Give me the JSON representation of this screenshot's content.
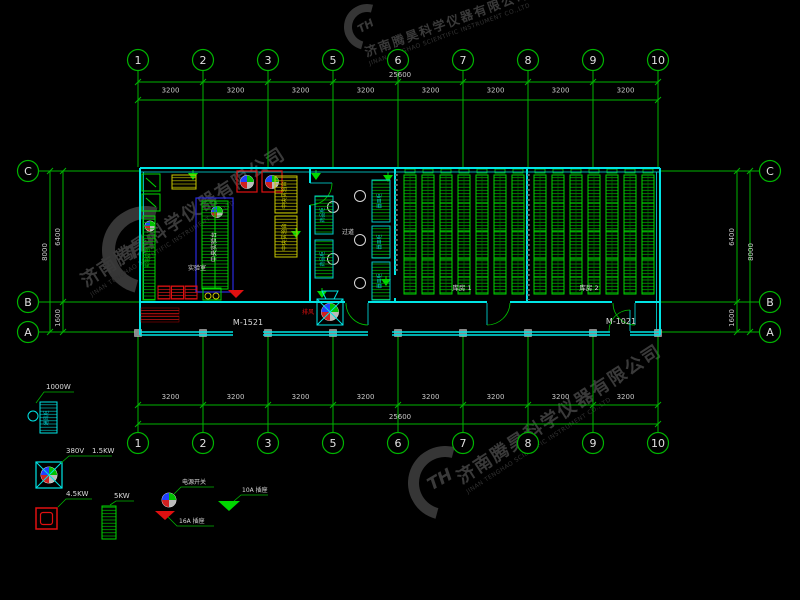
{
  "drawing": {
    "grid": {
      "top_labels": [
        "1",
        "2",
        "3",
        "5",
        "6",
        "7",
        "8",
        "9",
        "10"
      ],
      "bottom_labels": [
        "1",
        "2",
        "3",
        "5",
        "6",
        "7",
        "8",
        "9",
        "10"
      ],
      "left_labels": [
        "C",
        "B",
        "A"
      ],
      "right_labels": [
        "C",
        "B",
        "A"
      ]
    },
    "dims": {
      "segment": "3200",
      "total": "25600",
      "left_inner_top": "6400",
      "left_total": "8000",
      "left_inner_bottom": "1600",
      "right_inner_top": "6400",
      "right_total": "8000",
      "right_inner_bottom": "1600"
    },
    "labels": {
      "door_left": "M-1521",
      "door_right": "M-1021",
      "room_left": "实验室",
      "corridor": "过道",
      "storage1": "库房 1",
      "storage2": "库房 2",
      "central_bench": "中央实验台",
      "yellow_bench": "中央实验台",
      "side_bench": "实验边台",
      "cabinet_a": "药品柜",
      "cabinet_b": "器皿柜",
      "fan": "排风"
    },
    "legend": {
      "item1_power": "1000W",
      "item1_text": "通风柜",
      "item2_volt": "380V",
      "item2_power": "1.5KW",
      "item3_power": "4.5KW",
      "item4_power": "5KW",
      "item5_label": "电源开关",
      "item6_label": "16A 插座",
      "item7_label": "10A 插座"
    },
    "watermark": {
      "cn": "济南腾昊科学仪器有限公司",
      "en": "JINAN TENGHAO SCIENTIFIC INSTRUMENT CO.,LTD",
      "logo": "TH"
    },
    "colors": {
      "background": "#000000",
      "grid_green": "#00b400",
      "bench_green": "#00d800",
      "wall_cyan": "#00e5e5",
      "accent_red": "#e01010",
      "accent_yellow": "#c8c800",
      "accent_blue": "#2a2ae0",
      "dim_text": "#c8c8c8",
      "watermark_gray": "#3a3a3a"
    }
  }
}
